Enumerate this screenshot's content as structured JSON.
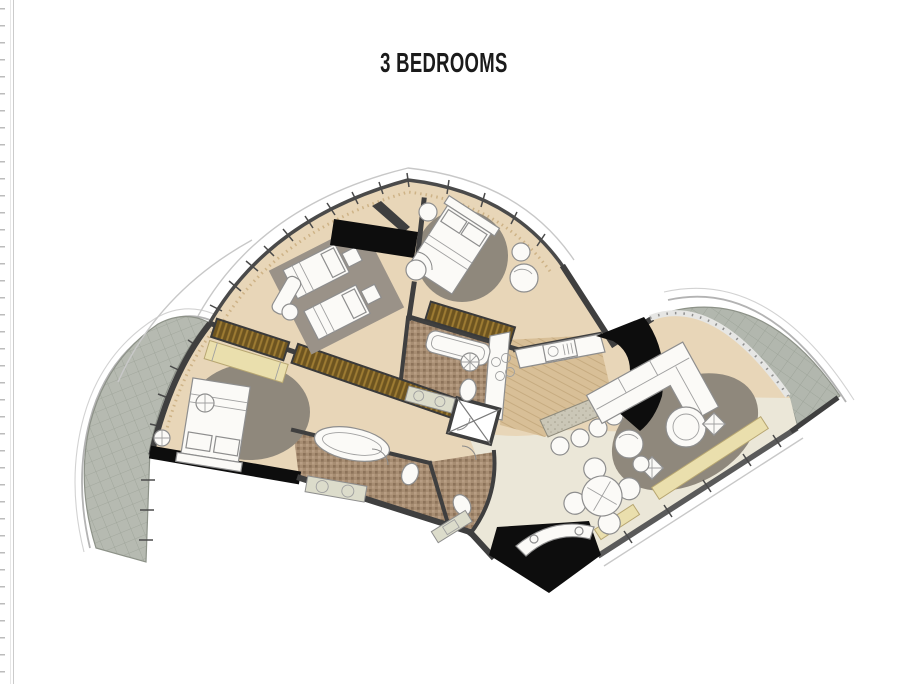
{
  "page": {
    "title": "3 BEDROOMS"
  },
  "palette": {
    "wallDark": "#3f3f3f",
    "wallBlack": "#0d0d0d",
    "floorBeige": "#e8d6b8",
    "floorCream": "#ebe7d8",
    "kitchenWood": "#d8bf97",
    "bathMosaic": "#a78d72",
    "terraceTile": "#b6bab1",
    "rugGray": "#8f887c",
    "wardrobeBrown": "#6d5420",
    "benchYellow": "#eadfad",
    "furnitureWhite": "#fbfaf7",
    "titleText": "#1b1b1b"
  }
}
